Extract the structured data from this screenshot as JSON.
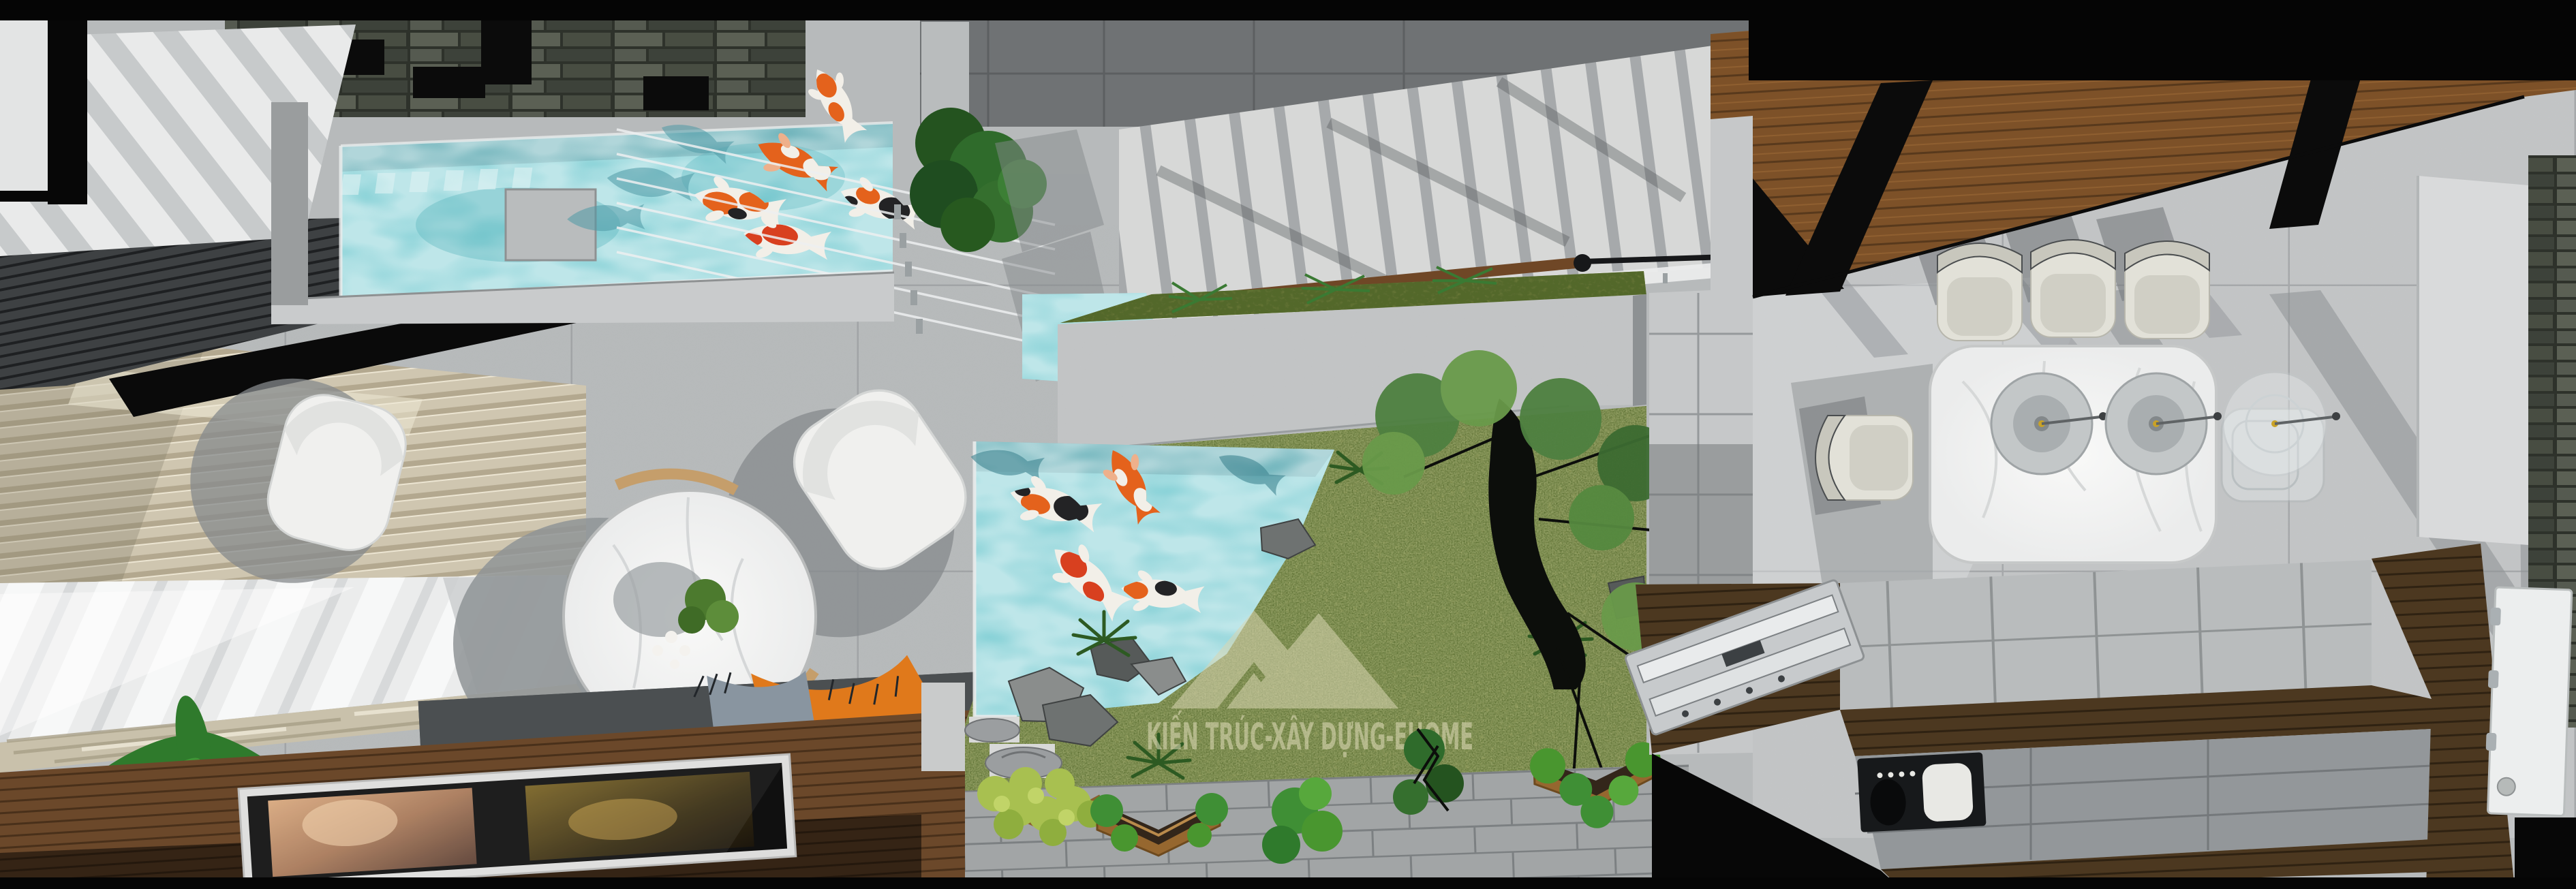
{
  "meta": {
    "kind": "3d-architectural-render",
    "view": "top-down interior plan render",
    "scene": "modern townhouse ground floor with koi ponds and courtyard garden"
  },
  "watermark": {
    "text": "KIẾN TRÚC-XÂY DỰNG-EHOME",
    "logo": "double-mountain-triangle",
    "color_hex": "#d9d6b2"
  },
  "rooms": [
    {
      "name": "living-room",
      "items": [
        "white armchair x2",
        "round marble coffee table",
        "dark grey sofa with orange pillows",
        "potted plant",
        "wooden deck with framed artwork",
        "beige venetian blinds",
        "sheer curtain window"
      ]
    },
    {
      "name": "upper-koi-pool",
      "koi_count": 5,
      "water_hex": "#7ccdd3",
      "features": [
        "stacked stone wall",
        "louvre deck",
        "cable railing",
        "green plant"
      ]
    },
    {
      "name": "staircase",
      "treads": 14,
      "handrail": "wood with black metal rail",
      "balustrade": "glass with posts"
    },
    {
      "name": "courtyard-garden",
      "koi_count": 4,
      "features": [
        "koi pond",
        "moss grass",
        "rocks",
        "tree silhouette",
        "ferns",
        "stone ornaments",
        "wooden planter boxes",
        "paver patio"
      ]
    },
    {
      "name": "dining-room",
      "table": "white marble rounded rectangle",
      "chairs": 8,
      "pendant_lights": 3,
      "ceiling": "wood slats"
    },
    {
      "name": "kitchen",
      "items": [
        "dark wood L-counter",
        "stainless cooktop",
        "built-in black appliance",
        "grey tile floor",
        "white hinged door",
        "stone feature wall",
        "white partition"
      ]
    }
  ],
  "palette": {
    "floor_concrete": "#b7babb",
    "floor_bright": "#c6c8c9",
    "floor_dark": "#6f7274",
    "pool_teal": "#7ccdd3",
    "grass": "#77823f",
    "wood_deck": "#6b482a",
    "wood_ceiling": "#7d5128",
    "counter_wood": "#4c3820",
    "sofa_grey": "#585c5e",
    "pillow_orange": "#e0791b",
    "chair_white": "#f0f0ee",
    "chair_cream": "#e2e1d8",
    "marble": "#f5f5f4",
    "stone_wall": "#2e322b",
    "black": "#0a0a0a"
  }
}
